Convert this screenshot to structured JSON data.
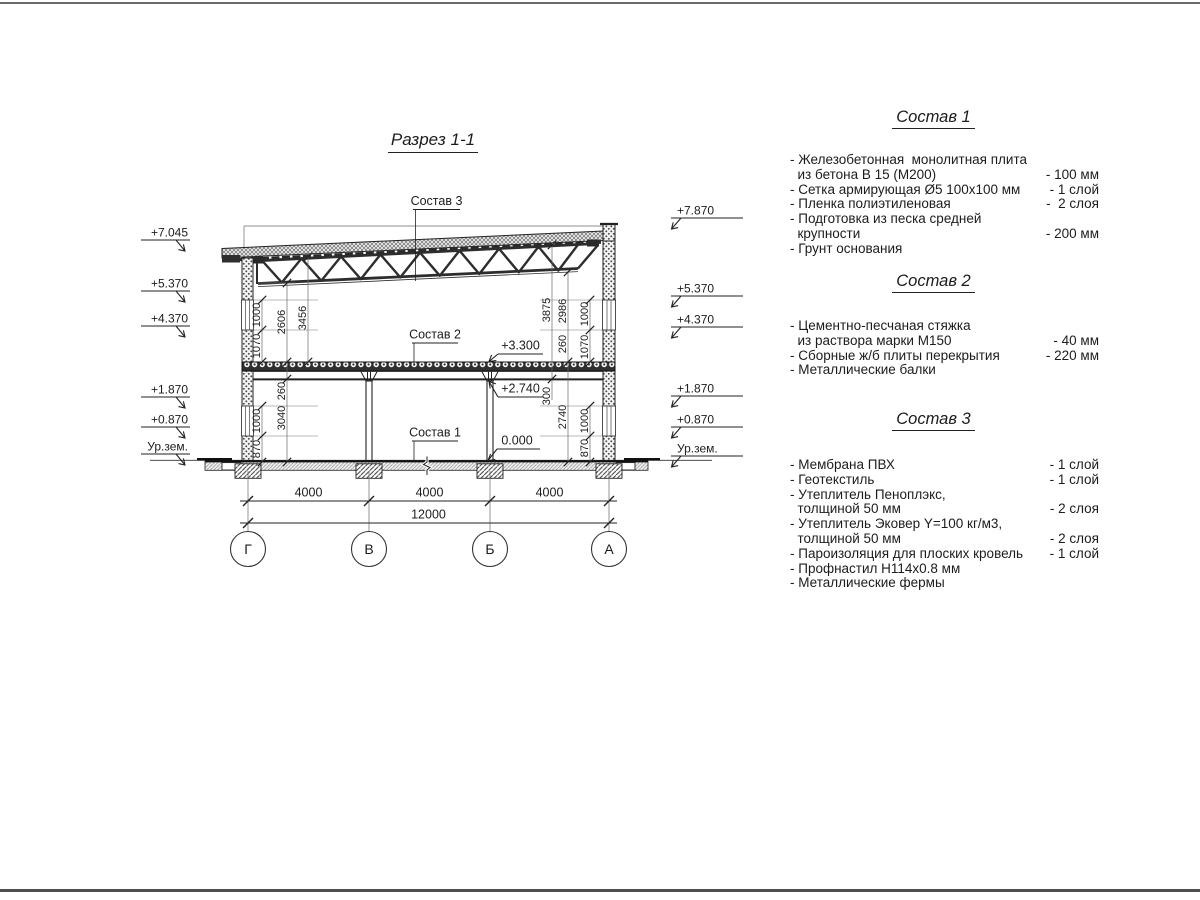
{
  "title": "Разрез 1-1",
  "colors": {
    "background": "#ffffff",
    "line": "#2b2b2b",
    "text": "#1c1c1c",
    "page_rule": "#5f5f5f"
  },
  "drawing": {
    "axes": [
      "Г",
      "В",
      "Б",
      "А"
    ],
    "dims_bottom": [
      "4000",
      "4000",
      "4000"
    ],
    "dim_total": "12000",
    "elev_left": [
      "+7.045",
      "+5.370",
      "+4.370",
      "+1.870",
      "+0.870",
      "Ур.зем."
    ],
    "elev_right": [
      "+7.870",
      "+5.370",
      "+4.370",
      "+1.870",
      "+0.870",
      "Ур.зем."
    ],
    "leaders": {
      "s3": "Состав 3",
      "s2": "Состав 2",
      "s1": "Состав 1",
      "l330": "+3.300",
      "l274": "+2.740",
      "l000": "0.000"
    },
    "vl": [
      "1000",
      "1070",
      "2606",
      "3456",
      "260",
      "3040",
      "1000",
      "870"
    ],
    "vr": [
      "3875",
      "2986",
      "1000",
      "260",
      "1070",
      "300",
      "2740",
      "1000",
      "870"
    ]
  },
  "specs": [
    {
      "heading": "Состав 1",
      "lines": [
        {
          "left": "- Железобетонная  монолитная плита",
          "right": ""
        },
        {
          "left": "  из бетона В 15 (М200)",
          "right": "- 100 мм"
        },
        {
          "left": "- Сетка армирующая Ø5 100х100 мм",
          "right": "- 1 слой"
        },
        {
          "left": "- Пленка полиэтиленовая",
          "right": "-  2 слоя"
        },
        {
          "left": "- Подготовка из песка средней",
          "right": ""
        },
        {
          "left": "  крупности",
          "right": "- 200 мм"
        },
        {
          "left": "- Грунт основания",
          "right": ""
        }
      ]
    },
    {
      "heading": "Состав 2",
      "lines": [
        {
          "left": "- Цементно-песчаная стяжка",
          "right": ""
        },
        {
          "left": "  из раствора марки М150",
          "right": "- 40 мм"
        },
        {
          "left": "- Сборные ж/б плиты перекрытия",
          "right": "- 220 мм"
        },
        {
          "left": "- Металлические балки",
          "right": ""
        }
      ]
    },
    {
      "heading": "Состав 3",
      "lines": [
        {
          "left": "- Мембрана ПВХ",
          "right": "- 1 слой"
        },
        {
          "left": "- Геотекстиль",
          "right": "- 1 слой"
        },
        {
          "left": "- Утеплитель Пеноплэкс,",
          "right": ""
        },
        {
          "left": "  толщиной 50 мм",
          "right": "- 2 слоя"
        },
        {
          "left": "- Утеплитель Эковер Y=100 кг/м3,",
          "right": ""
        },
        {
          "left": "  толщиной 50 мм",
          "right": "- 2 слоя"
        },
        {
          "left": "- Пароизоляция для плоских кровель",
          "right": "- 1 слой"
        },
        {
          "left": "- Профнастил Н114х0.8 мм",
          "right": ""
        },
        {
          "left": "- Металлические фермы",
          "right": ""
        }
      ]
    }
  ]
}
